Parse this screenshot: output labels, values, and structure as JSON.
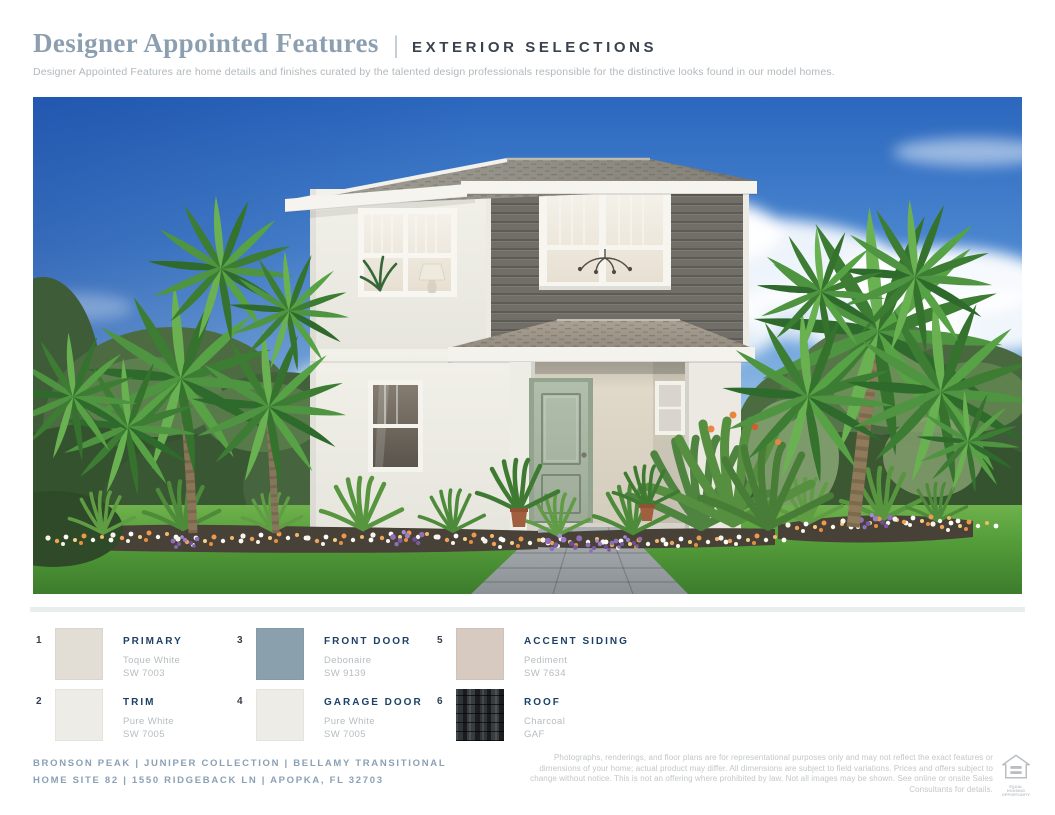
{
  "header": {
    "title": "Designer Appointed Features",
    "separator": "|",
    "category": "EXTERIOR SELECTIONS",
    "description": "Designer Appointed Features are home details and finishes curated by the talented design professionals responsible for the distinctive looks found in our model homes."
  },
  "rendering": {
    "description": "Two-story transitional home rendering with white stucco, gray accent lap siding, charcoal shingle roof, sage green front door, covered entry porch, palm trees and tropical landscaping under a blue sky"
  },
  "selections": [
    {
      "number": "1",
      "label": "PRIMARY",
      "name": "Toque White",
      "code": "SW 7003",
      "swatch": "#e2ded5"
    },
    {
      "number": "2",
      "label": "TRIM",
      "name": "Pure White",
      "code": "SW 7005",
      "swatch": "#edece6"
    },
    {
      "number": "3",
      "label": "FRONT DOOR",
      "name": "Debonaire",
      "code": "SW 9139",
      "swatch": "#8aa0ad"
    },
    {
      "number": "4",
      "label": "GARAGE DOOR",
      "name": "Pure White",
      "code": "SW 7005",
      "swatch": "#edece6"
    },
    {
      "number": "5",
      "label": "ACCENT SIDING",
      "name": "Pediment",
      "code": "SW 7634",
      "swatch": "#d6cac1"
    },
    {
      "number": "6",
      "label": "ROOF",
      "name": "Charcoal",
      "code": "GAF",
      "swatch": "#26292b"
    }
  ],
  "footer": {
    "line1": "BRONSON PEAK | JUNIPER COLLECTION | BELLAMY TRANSITIONAL",
    "line2": "HOME SITE 82 | 1550 RIDGEBACK LN  | APOPKA, FL 32703",
    "disclaimer": "Photographs, renderings, and floor plans are for representational purposes only and may not reflect the exact features or dimensions of your home; actual product may differ. All dimensions are subject to field variations. Prices and offers subject to change without notice. This is not an offering where prohibited by law. Not all images may be shown. See online or onsite Sales Consultants for details.",
    "eho": {
      "icon": "equal-housing-opportunity-logo",
      "line1": "EQUAL HOUSING",
      "line2": "OPPORTUNITY"
    }
  }
}
